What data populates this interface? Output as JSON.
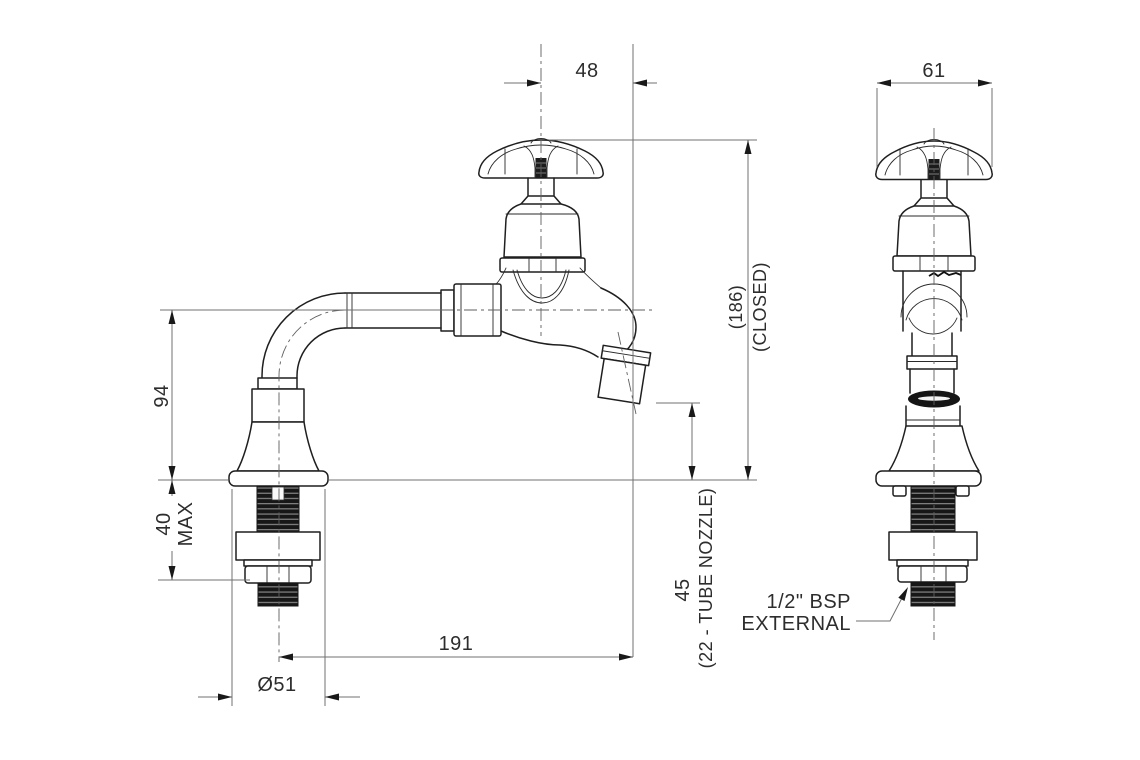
{
  "colors": {
    "background": "#ffffff",
    "outline": "#1f1f1f",
    "dimension_line": "#707070",
    "text": "#2d2d2d"
  },
  "side_view": {
    "name": "side elevation of bib tap",
    "dims": {
      "handle_to_outlet": "48",
      "inlet_height": "94",
      "deck_clamp_value": "40",
      "deck_clamp_note": "MAX",
      "base_diameter": "Ø51",
      "outlet_reach": "191",
      "outlet_clearance": "45",
      "outlet_note": "(22 - TUBE NOZZLE)",
      "closed_height": "(186)",
      "closed_note": "(CLOSED)"
    }
  },
  "front_view": {
    "name": "front elevation of bib tap",
    "dims": {
      "handle_width": "61"
    },
    "thread_callout": {
      "line1": "1/2\" BSP",
      "line2": "EXTERNAL"
    }
  }
}
